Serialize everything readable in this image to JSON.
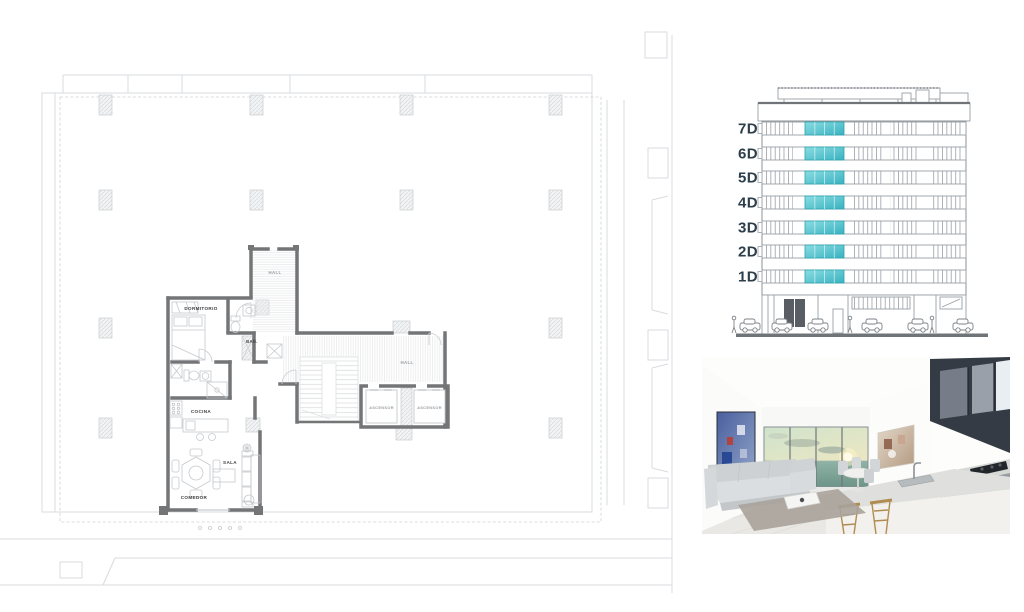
{
  "floor_plan": {
    "labels": {
      "hall_top": "HALL",
      "hall_main": "HALL",
      "dormitorio": "DORMITORIO",
      "banio": "BAÑ.",
      "cocina": "COCINA",
      "sala": "SALA",
      "comedor": "COMEDOR",
      "ascensor_left": "ASCENSOR",
      "ascensor_right": "ASCENSOR"
    },
    "colors": {
      "wall": "#737577",
      "outline": "#d9dbdd",
      "label_dark": "#3e4042",
      "label_gray": "#9aa0a4"
    }
  },
  "elevation": {
    "floor_labels": [
      "7D",
      "6D",
      "5D",
      "4D",
      "3D",
      "2D",
      "1D"
    ],
    "colors": {
      "highlight": "#46bfca",
      "line": "#9aa0a6",
      "label": "#2c3e4a"
    }
  }
}
